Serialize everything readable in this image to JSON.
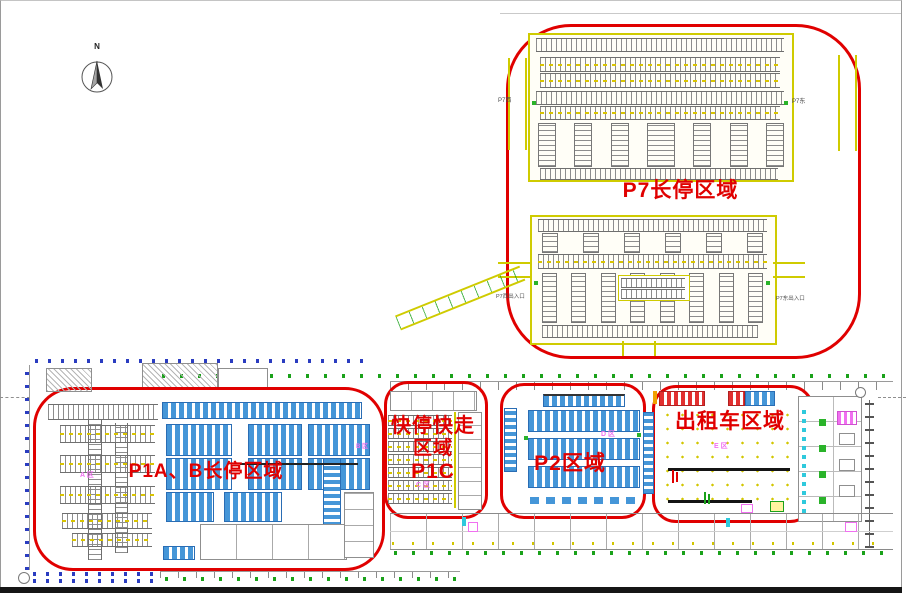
{
  "compass": {
    "north_label": "N"
  },
  "zones": {
    "p7": {
      "name": "P7长停区域",
      "gate_west": "P7西",
      "gate_east": "P7东",
      "entrance_west": "P7西出入口",
      "entrance_east": "P7东出入口"
    },
    "p1ab": {
      "name": "P1A、B长停区域",
      "area_a": "A 区",
      "area_b": "B 区"
    },
    "p1c": {
      "name_line1": "快停快走",
      "name_line2": "区域",
      "name_line3": "P1C",
      "area_c": "C 区"
    },
    "p2": {
      "name": "P2区域",
      "area_d": "D 区"
    },
    "taxi": {
      "name": "出租车区域",
      "area_e": "E 区"
    }
  },
  "colors": {
    "annotation_red": "#e00000",
    "cad_yellow": "#cfcb00",
    "stall_blue": "#4596d8",
    "stall_gray": "#8d8d8d",
    "label_magenta": "#f070f0",
    "grid_green": "#1aa11a",
    "grid_blue": "#2a3cc0"
  }
}
